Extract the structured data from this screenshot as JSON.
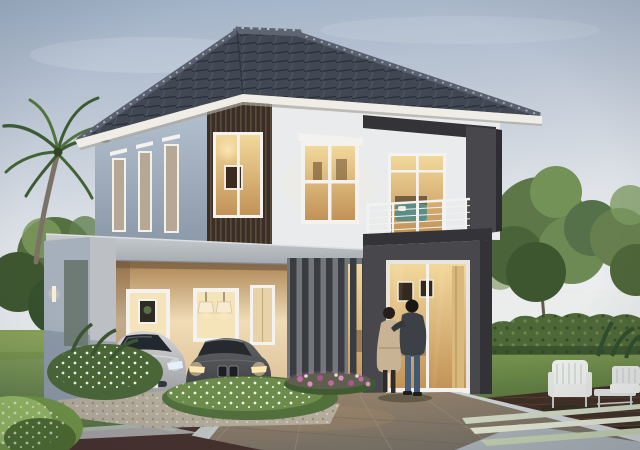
{
  "scene": {
    "kind": "3d-architectural-rendering",
    "subject": "Two-story modern house at dusk with carport, two parked cars, a couple on the lawn and landscaped garden"
  },
  "objects": {
    "house": "two-story modern house with hip tile roof",
    "roof": "dark grey tiled hip roof with white fascia",
    "wood_accent": "dark wood slat accent panel with lit window",
    "balcony": "upper balcony with wire railing and glass door",
    "carport": "grey concrete carport with two cars",
    "car_left": "silver hatchback with lit headlights",
    "car_right": "dark grey sedan with lit headlights",
    "slat_screen": "vertical fin privacy screen with flower bed",
    "glass_wall": "charcoal wall with warm-lit living-room glass door",
    "couple": "man and woman embracing on the lawn",
    "palm": "palm tree",
    "hedge": "trimmed hedge",
    "patio": "white patio chairs, bench and low table on wood deck",
    "garden": "white and pink flower beds with gravel edging"
  },
  "colors": {
    "sky_top": "#9fb0c6",
    "sky_bottom": "#eceef0",
    "roof": "#414853",
    "roof_ridge": "#5d6572",
    "fascia": "#efede6",
    "wall_front": "#eaebec",
    "wall_side": "#b2bfcd",
    "wood_slat_dark": "#392f26",
    "charcoal": "#48474c",
    "charcoal_dark": "#343338",
    "carport_grey": "#bcc0c5",
    "carport_side": "#a6b0bd",
    "interior_warm": "#e9c88e",
    "interior_bright": "#f5e3ba",
    "grass": "#66813f",
    "hedge_green": "#4f6838",
    "tree_green": "#5d7748",
    "tree_dark": "#3e5630",
    "tree_light": "#7d9a61",
    "driveway": "#86776412",
    "driveway_main": "#867764",
    "concrete": "#a9b0b6",
    "deck_brown": "#402e24",
    "edging_maroon": "#46302c",
    "flower_white": "#eef0e8",
    "flower_pink": "#c06ba6",
    "gravel": "#b5ac9c",
    "car_silver": "#b5b7ba",
    "car_dark": "#4b4c50",
    "glass_dark": "#23282e",
    "headlight_glow": "#ffe7b0",
    "railing_white": "#f2f2f0",
    "frame_white": "#f4f2ee",
    "woman_coat": "#c8b495",
    "man_jacket": "#3d4046",
    "jeans_blue": "#47617c",
    "trunk_brown": "#7a7265",
    "floor_warm": "#8a6e50"
  }
}
